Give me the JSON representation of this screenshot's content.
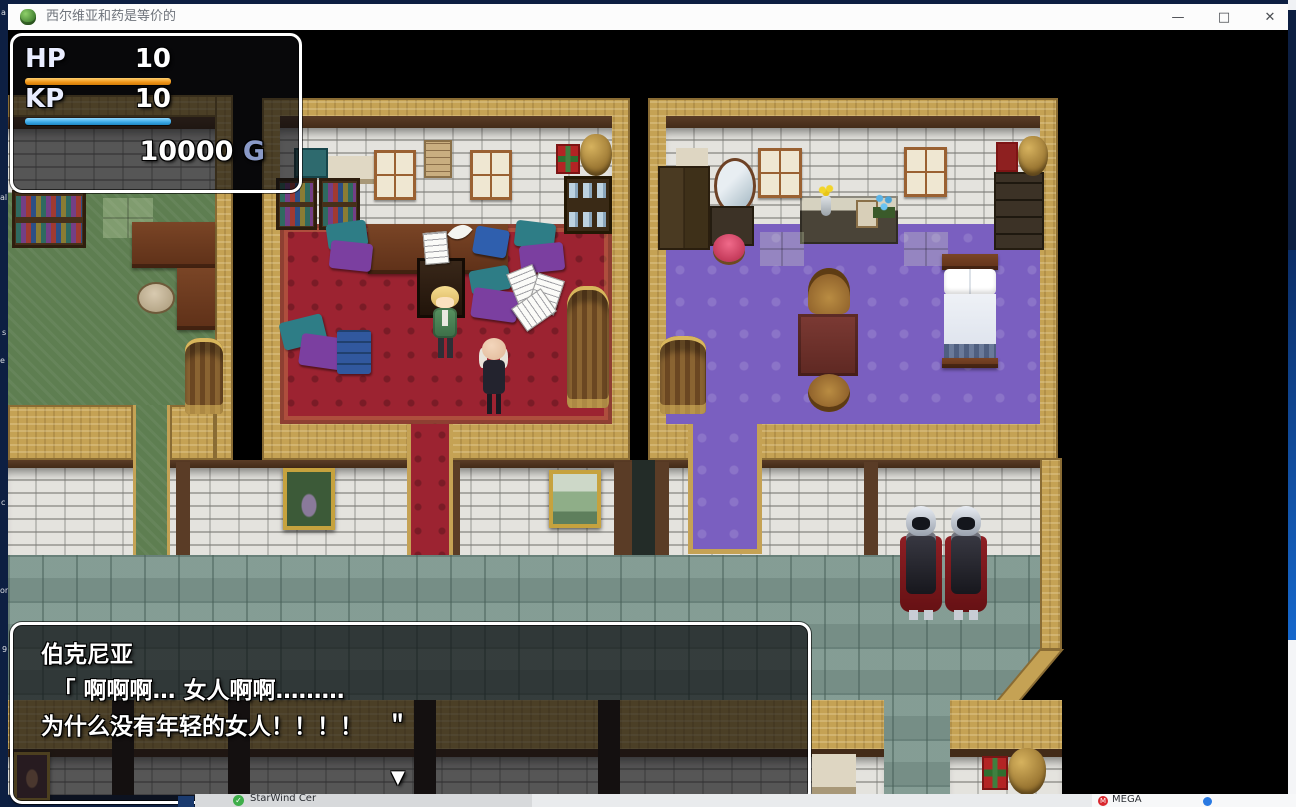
{
  "window": {
    "title": "西尔维亚和药是等价的",
    "minimize": "—",
    "maximize": "□",
    "close": "✕"
  },
  "hud": {
    "hp_label": "HP",
    "hp_value": "10",
    "kp_label": "KP",
    "kp_value": "10",
    "gold_value": "10000",
    "gold_unit": "G",
    "hp_bar_color": "#ef9418",
    "kp_bar_color": "#3aa8e6",
    "gold_unit_color": "#8a9ac8"
  },
  "dialogue": {
    "speaker": "伯克尼亚",
    "line1": "　「 啊啊啊… 女人啊啊………",
    "line2": "为什么没有年轻的女人！！！！　＂",
    "continue_indicator": "▼"
  },
  "background_windows": {
    "starwind_label": "StarWind Cer",
    "mega_label": "MEGA"
  },
  "desktop_fragments": {
    "f0": "a",
    "f1": "al",
    "f2": "s",
    "f3": "e",
    "f4": "c",
    "f5": "or",
    "f6": "9"
  },
  "scene": {
    "map_colors": {
      "office_floor": "#9c2331",
      "bedroom_floor": "#7a5fc0",
      "left_room_floor": "#5e7e51",
      "street_floor": "#7d978e",
      "wall_gold": "#c5a254",
      "guard_cape": "#8e1f24"
    }
  }
}
